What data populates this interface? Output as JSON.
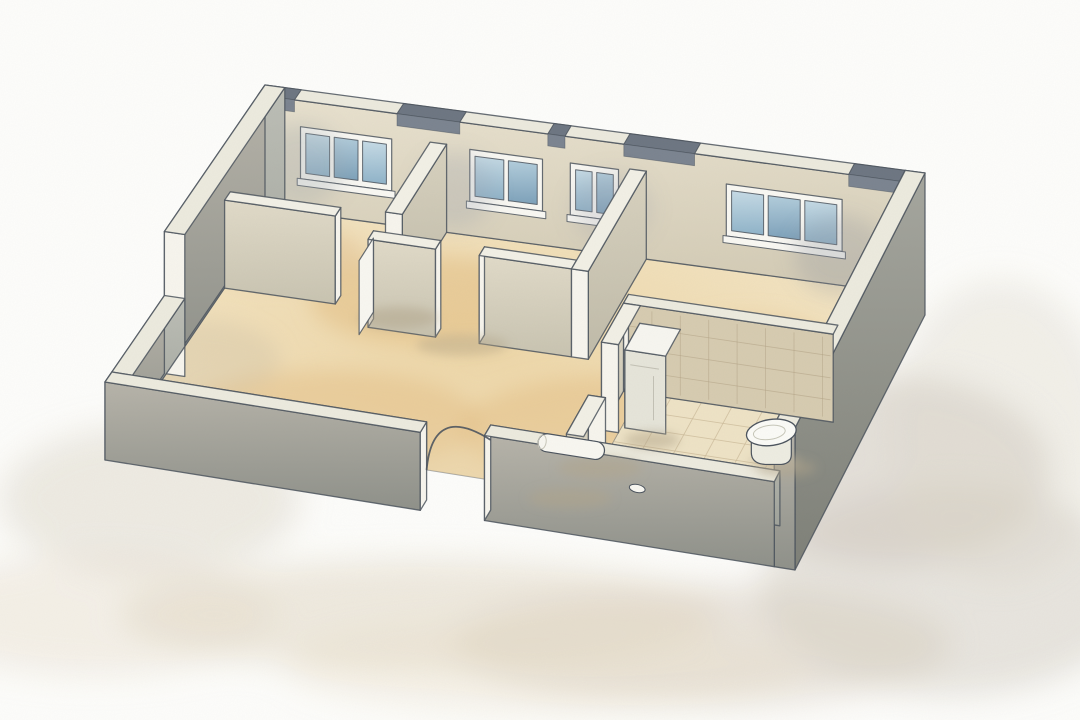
{
  "illustration": {
    "kind": "isometric-cutaway-floor-plan",
    "style": "watercolor",
    "window_units": 4,
    "rooms_visible": 5,
    "fixtures_visible": [
      "toilet",
      "tall-white-cabinet",
      "rolled-towel",
      "slipper",
      "open-door-leaf",
      "door-swing-arc"
    ]
  },
  "canvas": {
    "w": 1080,
    "h": 720
  },
  "projection": {
    "origin": [
      265,
      197
    ],
    "u": [
      660,
      88
    ],
    "v": [
      -160,
      233
    ],
    "w": [
      30,
      22
    ],
    "plan": [
      10,
      7
    ]
  },
  "heights": {
    "outer": 112,
    "partition": 88,
    "low": 48,
    "front_right": 55,
    "appliance": 78,
    "stub": 58,
    "plinth": 30,
    "leaf": 74
  },
  "colors": {
    "flat": {
      "paper": "#fdfdfb",
      "outline": "#4b535d",
      "capLight": "#eceade",
      "capWhite": "#f2f0e5",
      "endWhite": "#f7f5ed",
      "frame": "#f9f8f3",
      "lintel": "#6d7682",
      "lintelShade": "#7b8490",
      "tileWall": "#d6cbb0",
      "tileLine": "#b1a184",
      "bathFloor": "#eee3c6",
      "bathLine": "#c9b795",
      "white": "#f8f7f1",
      "applianceTop": "#f7f6f0",
      "applianceSide": "#eeede5",
      "applianceFront": "#e5e4d9",
      "toiletTop": "#fbfbf7",
      "toiletBody": "#edece1",
      "toiletLine": "#c6c6b8"
    },
    "gradients": {
      "gradBack": [
        "#e9e2cf",
        "#d2cab4"
      ],
      "gradPart": [
        "#e0dac8",
        "#c8c3b0"
      ],
      "gradPartE": [
        "#d8d2bf",
        "#bfbaa8"
      ],
      "gradMid": [
        "#bcbeb6",
        "#9fa29a"
      ],
      "gradMidTall": [
        "#b6b3a9",
        "#8e9089"
      ],
      "gradDark": [
        "#939aa1",
        "#727a83"
      ],
      "gradOuterDark": [
        "#a5a69e",
        "#7d7f77"
      ],
      "glassA": [
        "#c6dbe6",
        "#8fb3c9"
      ],
      "glassB": [
        "#b2cddc",
        "#7da1ba"
      ]
    },
    "floorRadial": [
      "#eed7a8",
      "#f4e9cd"
    ]
  },
  "walls": [
    {
      "id": "back-wall",
      "x": [
        0,
        10
      ],
      "y": [
        0,
        0.3
      ],
      "h": "outer",
      "cap": "capLight",
      "faces": [
        {
          "side": "S",
          "fill": "gradBack"
        }
      ]
    },
    {
      "id": "left-wall-tall",
      "x": [
        0,
        0.3
      ],
      "y": [
        0,
        4.4
      ],
      "h": "outer",
      "cap": "capLight",
      "faces": [
        {
          "side": "E",
          "fill": "gradMid"
        },
        {
          "side": "W",
          "fill": "gradMidTall",
          "drop": 30
        },
        {
          "side": "S",
          "fill": "endWhite",
          "drop": 30
        }
      ]
    },
    {
      "id": "partition-a",
      "x": [
        2.6,
        2.85
      ],
      "y": [
        0.3,
        2.35
      ],
      "h": "partition",
      "cap": "capWhite",
      "faces": [
        {
          "side": "E",
          "fill": "gradPartE"
        },
        {
          "side": "S",
          "fill": "endWhite"
        }
      ]
    },
    {
      "id": "partition-b",
      "x": [
        0.3,
        1.95
      ],
      "y": [
        2.4,
        2.65
      ],
      "h": "partition",
      "cap": "capWhite",
      "faces": [
        {
          "side": "S",
          "fill": "gradPart"
        },
        {
          "side": "E",
          "fill": "endWhite"
        }
      ]
    },
    {
      "id": "mid-front-wall-1",
      "x": [
        2.6,
        3.6
      ],
      "y": [
        2.9,
        3.15
      ],
      "h": "partition",
      "cap": "capWhite",
      "faces": [
        {
          "side": "S",
          "fill": "gradPart"
        },
        {
          "side": "E",
          "fill": "endWhite"
        },
        {
          "side": "W",
          "fill": "endWhite"
        }
      ]
    },
    {
      "id": "mid-front-wall-2",
      "x": [
        4.25,
        5.62
      ],
      "y": [
        2.9,
        3.15
      ],
      "h": "partition",
      "cap": "capWhite",
      "faces": [
        {
          "side": "S",
          "fill": "gradPart"
        },
        {
          "side": "W",
          "fill": "endWhite"
        }
      ]
    },
    {
      "id": "partition-c",
      "x": [
        5.62,
        5.87
      ],
      "y": [
        0.3,
        3.15
      ],
      "h": "partition",
      "cap": "capWhite",
      "faces": [
        {
          "side": "E",
          "fill": "gradPartE"
        },
        {
          "side": "S",
          "fill": "endWhite"
        }
      ]
    },
    {
      "id": "right-wall",
      "x": [
        9.7,
        10
      ],
      "y": [
        0,
        7
      ],
      "h": "outer",
      "cap": "capLight",
      "faces": [
        {
          "side": "W",
          "fill": "gradDark"
        },
        {
          "side": "E",
          "fill": "gradOuterDark",
          "drop": 30
        },
        {
          "side": "S",
          "fill": "gradMidTall",
          "drop": 30
        }
      ]
    },
    {
      "id": "bathroom-north-wall",
      "x": [
        6.6,
        9.7
      ],
      "y": [
        3.6,
        3.85
      ],
      "h": "partition",
      "cap": "capLight",
      "faces": [
        {
          "side": "S",
          "fill": "tileWall",
          "grid": true
        },
        {
          "side": "W",
          "fill": "endWhite"
        }
      ]
    },
    {
      "id": "bathroom-west-wall-back",
      "x": [
        6.6,
        6.85
      ],
      "y": [
        3.85,
        4.95
      ],
      "h": "partition",
      "cap": "capWhite",
      "faces": [
        {
          "side": "W",
          "fill": "gradPart"
        },
        {
          "side": "S",
          "fill": "endWhite"
        }
      ]
    },
    {
      "id": "water-heater-cabinet",
      "x": [
        6.9,
        7.5
      ],
      "y": [
        4.05,
        4.8
      ],
      "h": "appliance",
      "cap": "applianceTop",
      "faces": [
        {
          "side": "W",
          "fill": "applianceSide"
        },
        {
          "side": "S",
          "fill": "applianceFront",
          "seam": true
        }
      ]
    },
    {
      "id": "bathroom-west-wall-stub",
      "x": [
        6.6,
        6.85
      ],
      "y": [
        5.6,
        6.7
      ],
      "h": "stub",
      "cap": "capWhite",
      "faces": [
        {
          "side": "W",
          "fill": "gradPart"
        },
        {
          "side": "N",
          "fill": "endWhite"
        }
      ]
    },
    {
      "id": "left-wall-low",
      "x": [
        0,
        0.3
      ],
      "y": [
        4.4,
        7
      ],
      "h": "low",
      "cap": "capLight",
      "faces": [
        {
          "side": "E",
          "fill": "gradMid"
        },
        {
          "side": "W",
          "fill": "gradMidTall",
          "drop": 30
        }
      ]
    },
    {
      "id": "front-wall-left",
      "x": [
        0,
        4.57
      ],
      "y": [
        6.7,
        7
      ],
      "h": "low",
      "cap": "capLight",
      "faces": [
        {
          "side": "N",
          "fill": "gradMid"
        },
        {
          "side": "S",
          "fill": "gradMidTall",
          "drop": 30
        },
        {
          "side": "E",
          "fill": "endWhite",
          "drop": 30
        }
      ]
    },
    {
      "id": "front-wall-right",
      "x": [
        5.5,
        9.7
      ],
      "y": [
        6.7,
        7
      ],
      "h": "front_right",
      "cap": "capLight",
      "faces": [
        {
          "side": "N",
          "fill": "gradMid"
        },
        {
          "side": "S",
          "fill": "gradMidTall",
          "drop": 30
        },
        {
          "side": "W",
          "fill": "endWhite",
          "drop": 30
        }
      ]
    }
  ],
  "windows": {
    "head": 86,
    "sill": 34,
    "inset_h": 6,
    "inset_x": 0.08,
    "gap": 0.07,
    "items": [
      {
        "id": "window-1",
        "x": [
          0.64,
          2.02
        ],
        "panes": 3
      },
      {
        "id": "window-2",
        "x": [
          3.2,
          4.3
        ],
        "panes": 2
      },
      {
        "id": "window-3",
        "x": [
          4.72,
          5.45
        ],
        "panes": 2
      },
      {
        "id": "window-4",
        "x": [
          7.08,
          8.83
        ],
        "panes": 3
      }
    ]
  },
  "lintels": [
    [
      0,
      0.55
    ],
    [
      2.1,
      3.05
    ],
    [
      4.38,
      4.64
    ],
    [
      5.53,
      6.6
    ],
    [
      8.93,
      10
    ]
  ],
  "bathroom_floor": {
    "x": [
      6.85,
      9.7
    ],
    "y": [
      3.85,
      6.7
    ],
    "step": 0.45
  },
  "door": {
    "left_jamb": [
      4.57,
      6.7
    ],
    "right_jamb": [
      5.5,
      6.7
    ],
    "leaf_top": 40
  },
  "door_leaf": {
    "x": 2.54,
    "y": [
      2.72,
      3.38
    ]
  },
  "fixtures": {
    "toilet": {
      "at": [
        9.18,
        5.05
      ]
    },
    "towel_roll": {
      "from": [
        6.22,
        6.8
      ],
      "to": [
        7.18,
        6.8
      ],
      "lift": 50,
      "r": 9
    },
    "slipper": {
      "at": [
        7.52,
        6.32
      ]
    }
  },
  "shadows": {
    "ground": [
      {
        "e": [
          890,
          470,
          160,
          95
        ],
        "c": "#cbc4b8",
        "o": 0.5
      },
      {
        "e": [
          950,
          590,
          190,
          105
        ],
        "c": "#cfc8bc",
        "o": 0.45
      },
      {
        "e": [
          700,
          645,
          250,
          60
        ],
        "c": "#d8cec0",
        "o": 0.5
      },
      {
        "e": [
          420,
          615,
          300,
          55
        ],
        "c": "#e2d8c3",
        "o": 0.5
      },
      {
        "e": [
          150,
          500,
          150,
          75
        ],
        "c": "#d8cfc0",
        "o": 0.4
      },
      {
        "e": [
          95,
          615,
          180,
          60
        ],
        "c": "#e6ddca",
        "o": 0.4
      },
      {
        "e": [
          545,
          665,
          260,
          45
        ],
        "c": "#e8ddc6",
        "o": 0.35
      },
      {
        "e": [
          1000,
          430,
          110,
          150
        ],
        "c": "#ddd6c9",
        "o": 0.35
      }
    ],
    "floor_splotches": [
      {
        "e": [
          430,
          300,
          120,
          45
        ],
        "c": "#e3bd82",
        "o": 0.5
      },
      {
        "e": [
          330,
          420,
          150,
          50
        ],
        "c": "#e6c188",
        "o": 0.55
      },
      {
        "e": [
          620,
          430,
          160,
          55
        ],
        "c": "#e2ba7e",
        "o": 0.45
      },
      {
        "e": [
          285,
          255,
          80,
          30
        ],
        "c": "#dfba84",
        "o": 0.4
      },
      {
        "e": [
          750,
          350,
          90,
          35
        ],
        "c": "#e5c28a",
        "o": 0.4
      },
      {
        "e": [
          520,
          480,
          150,
          42
        ],
        "c": "#ead0a0",
        "o": 0.5
      },
      {
        "e": [
          200,
          360,
          80,
          40
        ],
        "c": "#cfc0a6",
        "o": 0.35
      }
    ],
    "wall_washes": [
      {
        "e": [
          300,
          165,
          44,
          42
        ],
        "c": "#99a0aa",
        "o": 0.28
      },
      {
        "e": [
          455,
          190,
          38,
          38
        ],
        "c": "#99a0aa",
        "o": 0.26
      },
      {
        "e": [
          612,
          208,
          40,
          36
        ],
        "c": "#99a0aa",
        "o": 0.24
      },
      {
        "e": [
          840,
          255,
          46,
          40
        ],
        "c": "#8e959f",
        "o": 0.28
      }
    ],
    "contact": [
      {
        "e": [
          398,
          318,
          40,
          11
        ],
        "c": "#b2a489",
        "o": 0.5
      },
      {
        "e": [
          462,
          345,
          46,
          11
        ],
        "c": "#b2a489",
        "o": 0.42
      },
      {
        "e": [
          600,
          468,
          42,
          11
        ],
        "c": "#b2a489",
        "o": 0.45
      },
      {
        "e": [
          652,
          440,
          28,
          9
        ],
        "c": "#b2a489",
        "o": 0.5
      },
      {
        "e": [
          570,
          498,
          42,
          10
        ],
        "c": "#b2a489",
        "o": 0.42
      },
      {
        "e": [
          786,
          468,
          30,
          9
        ],
        "c": "#b2a489",
        "o": 0.45
      }
    ]
  }
}
